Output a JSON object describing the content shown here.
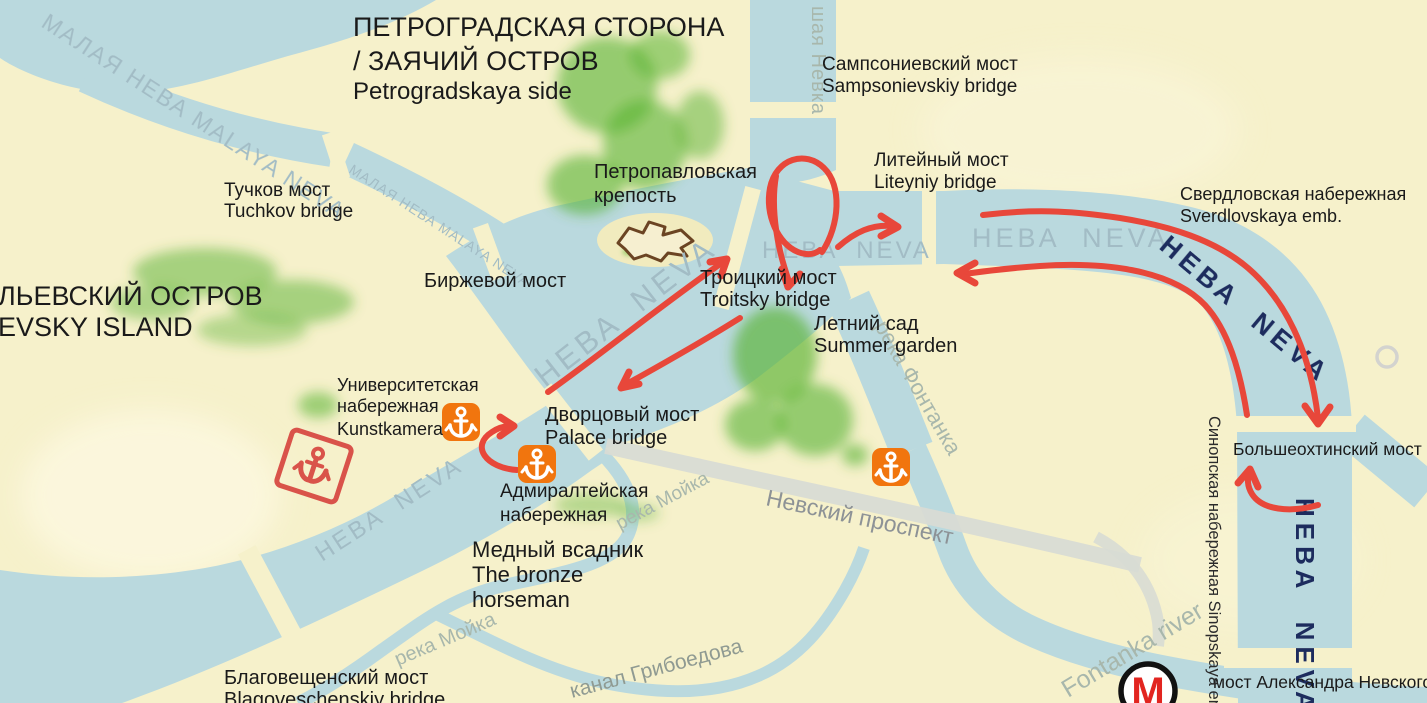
{
  "colors": {
    "land": "#f6f1cb",
    "water": "#bad9de",
    "water_label": "#a2bcc5",
    "navy_label": "#1d2c5e",
    "green_park": "#57b231",
    "annotation_red": "#e8473a",
    "sketch_red": "#d9534a",
    "anchor_orange": "#f1750e",
    "road_grey": "#d8dbd4",
    "label_black": "#1a1a1a",
    "fortress_brown": "#6b4423",
    "metro_red": "#e22520"
  },
  "labels": {
    "petrogradskaya": {
      "l1": "ПЕТРОГРАДСКАЯ СТОРОНА",
      "l2": "/ ЗАЯЧИЙ ОСТРОВ",
      "l3": "Petrogradskaya side"
    },
    "sampsonievskiy": {
      "l1": "Сампсониевский мост",
      "l2": "Sampsonievskiy  bridge"
    },
    "liteyniy": {
      "l1": "Литейный мост",
      "l2": "Liteyniy bridge"
    },
    "sverdlovskaya": {
      "l1": "Свердловская набережная",
      "l2": "Sverdlovskaya emb."
    },
    "tuchkov": {
      "l1": "Тучков мост",
      "l2": "Tuchkov bridge"
    },
    "vasilevsky": {
      "l1": "ЛЬЕВСКИЙ ОСТРОВ",
      "l2": "EVSKY ISLAND"
    },
    "petropavlovskaya": {
      "l1": "Петропавловская",
      "l2": "крепость"
    },
    "birzhevoy": {
      "l1": "Биржевой мост"
    },
    "troitsky": {
      "l1": "Троицкий мост",
      "l2": "Troitsky bridge"
    },
    "summer_garden": {
      "l1": "Летний сад",
      "l2": "Summer garden"
    },
    "universitetskaya": {
      "l1": "Университетская",
      "l2": "набережная",
      "l3": "Kunstkamera"
    },
    "palace": {
      "l1": "Дворцовый мост",
      "l2": "Palace bridge"
    },
    "admiralteyskaya": {
      "l1": "Адмиралтейская",
      "l2": "набережная"
    },
    "bronze_horseman": {
      "l1": "Медный всадник",
      "l2": "The bronze",
      "l3": "horseman"
    },
    "blagoveschenskiy": {
      "l1": "Благовещенский мост",
      "l2": "Blagoveschenskiy bridge"
    },
    "bolsheokhtinsky": {
      "l1": "Большеохтинский мост"
    },
    "alexander_nevsky": {
      "l1": "мост Александра Невского"
    },
    "sinopskaya": {
      "l1": "Синопская набережная Sinopskaya em"
    }
  },
  "water_labels": {
    "malaya_neva_1": "МАЛАЯ НЕВА MALAYA NEVA",
    "malaya_neva_2": "МАЛАЯ НЕВА MALAYA NEVA",
    "bolshaya_nevka": "шая Невка",
    "neva_basin": "НЕВА NEVA",
    "neva_center": "НЕВА NEVA",
    "neva_east": "НЕВА NEVA",
    "neva_sw": "НЕВА NEVA",
    "neva_bend_navy": "НЕВА NEVA",
    "neva_vertical_navy": "НЕВА NEVA",
    "moyka_1": "река Мойка",
    "moyka_2": "река Мойка",
    "fontanka_ru": "река Фонтанка",
    "fontanka_en": "Fontanka river",
    "griboedov": "канал Грибоедова",
    "nevsky_prospekt": "Невский проспект"
  },
  "icons": {
    "metro": {
      "letter": "M",
      "color": "#e22520",
      "shape": "white-circle-black-ring"
    },
    "port_anchor": {
      "glyph": "anchor",
      "color": "#f1750e",
      "count": 3
    },
    "sketch_anchor": {
      "glyph": "anchor-outline-box",
      "color": "#d9534a"
    },
    "fortress": {
      "glyph": "bastion-star-outline",
      "color": "#6b4423"
    },
    "location_ring": {
      "glyph": "circle-outline",
      "color": "#cfcfcf"
    }
  },
  "annotations": {
    "style": "hand-drawn red marker arrows",
    "color": "#e8473a",
    "items": [
      "loop-turnaround-near-troitsky-bridge",
      "arrow-east-toward-liteyniy",
      "arrow-northeast-across-basin",
      "arrow-southwest-toward-palace-bridge",
      "small-curl-arrow-near-admiralty-pier",
      "long-arrow-east-downstream-to-bolsheokhtinsky",
      "long-arrow-west-upstream-along-neva",
      "small-curl-arrow-north-near-bolsheokhtinsky"
    ]
  }
}
